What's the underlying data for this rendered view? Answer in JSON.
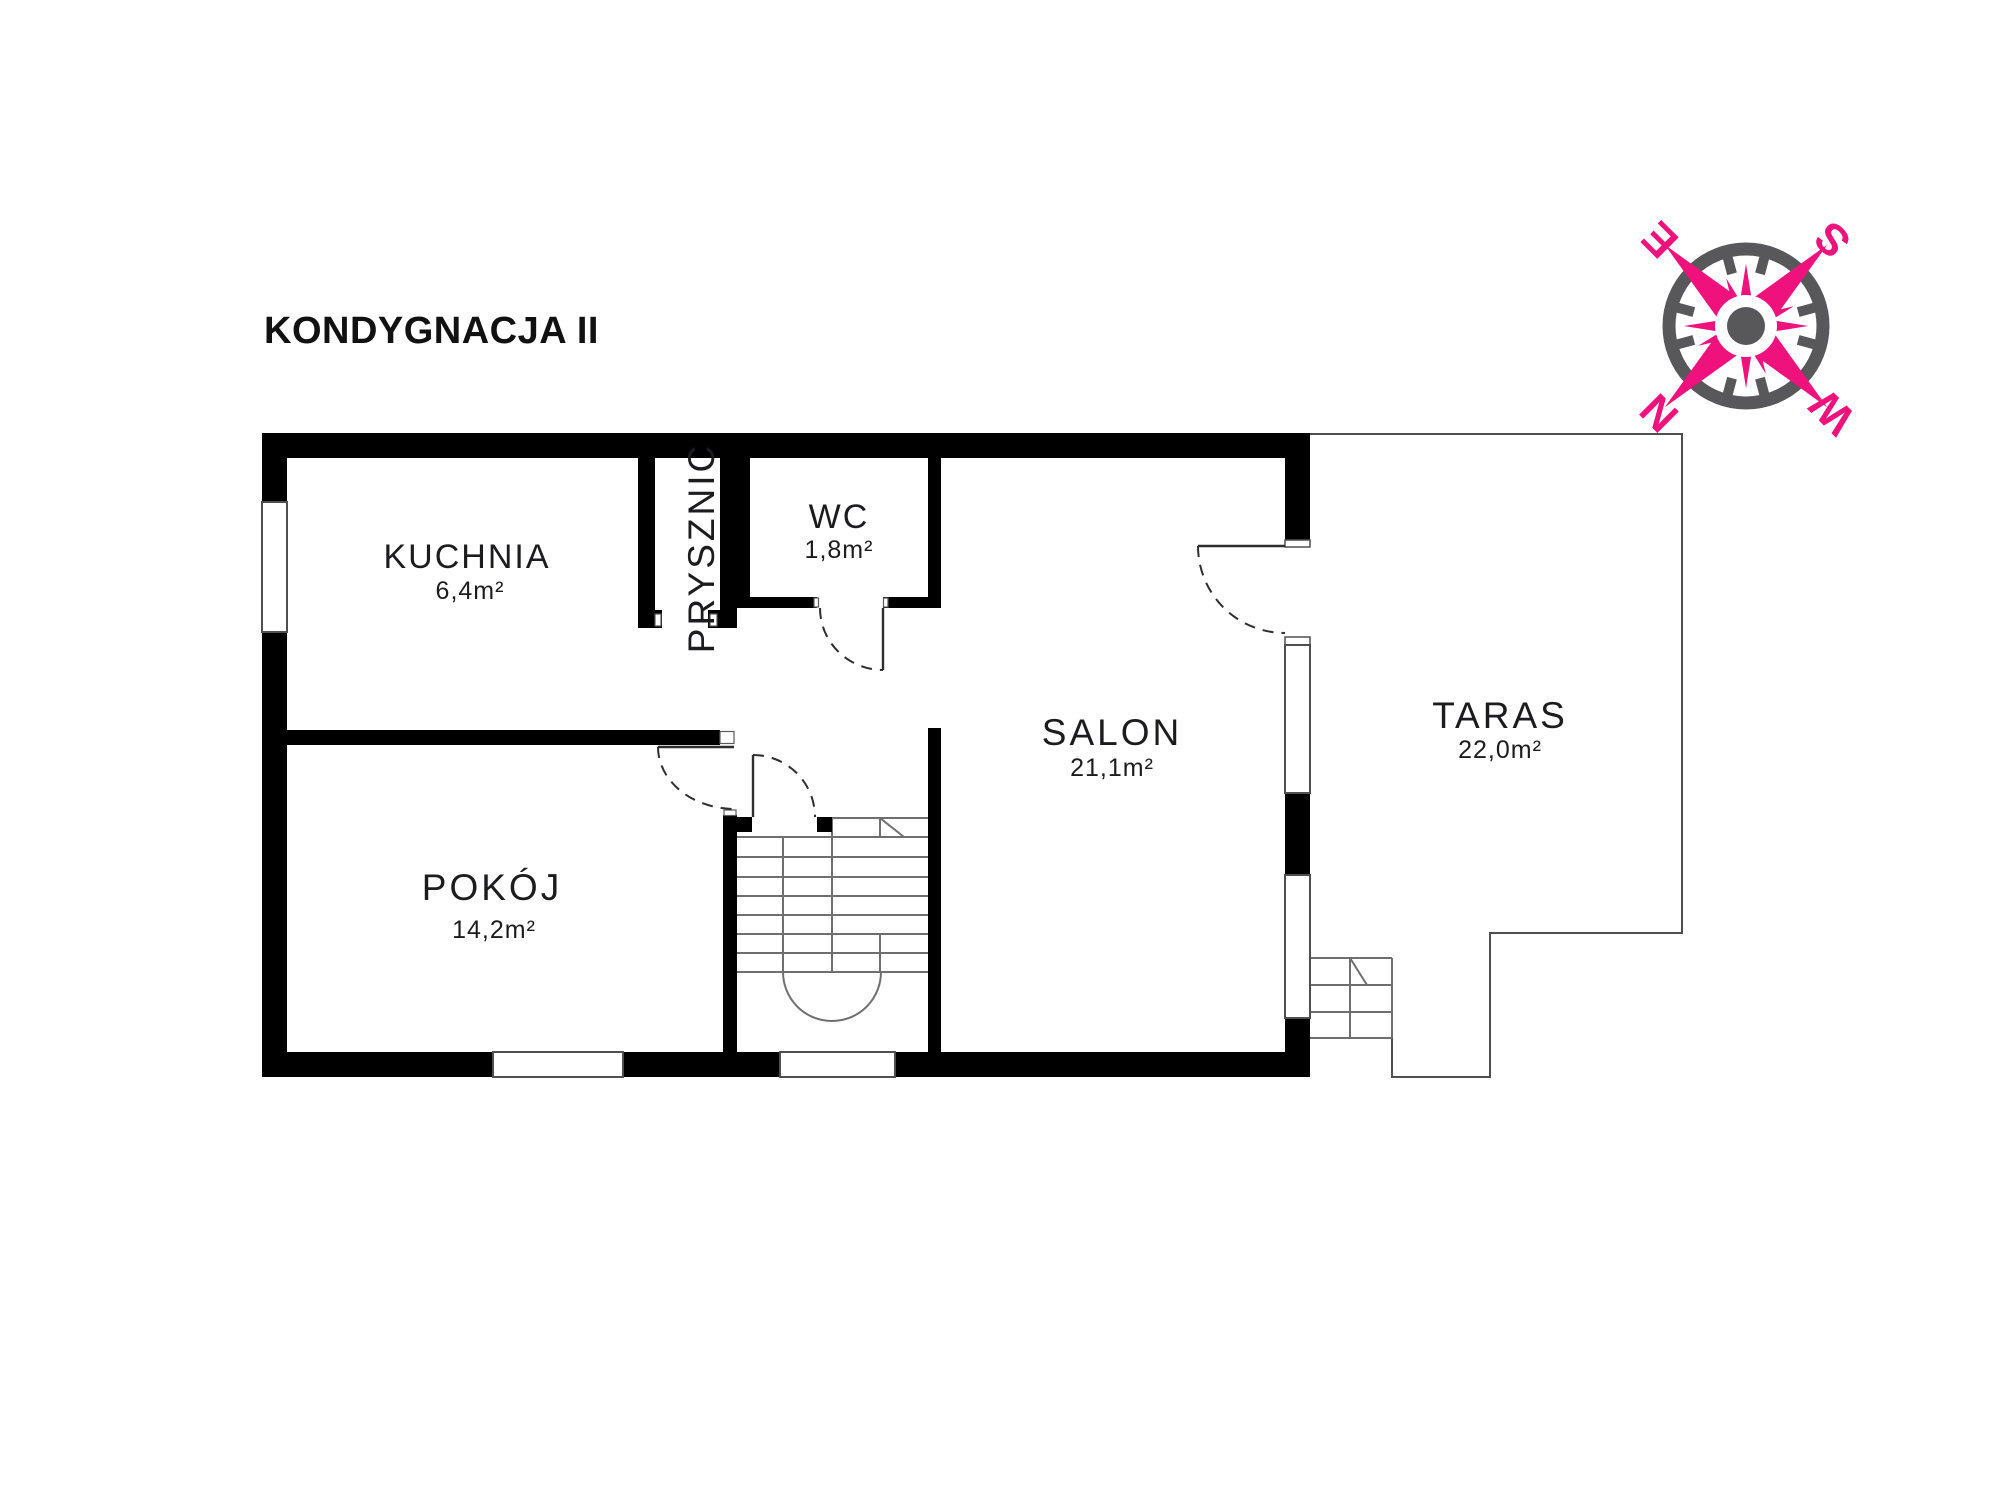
{
  "title": "KONDYGNACJA II",
  "rooms": [
    {
      "name": "KUCHNIA",
      "area": "6,4m²"
    },
    {
      "name": "PRYSZNIC"
    },
    {
      "name": "WC",
      "area": "1,8m²"
    },
    {
      "name": "SALON",
      "area": "21,1m²"
    },
    {
      "name": "POKÓJ",
      "area": "14,2m²"
    },
    {
      "name": "TARAS",
      "area": "22,0m²"
    }
  ],
  "compass": {
    "north": "N",
    "south": "S",
    "east": "E",
    "west": "W"
  },
  "colors": {
    "wall": "#000000",
    "accent_pink": "#EF117C",
    "compass_gray": "#58585A",
    "line": "#4F4F4F"
  }
}
